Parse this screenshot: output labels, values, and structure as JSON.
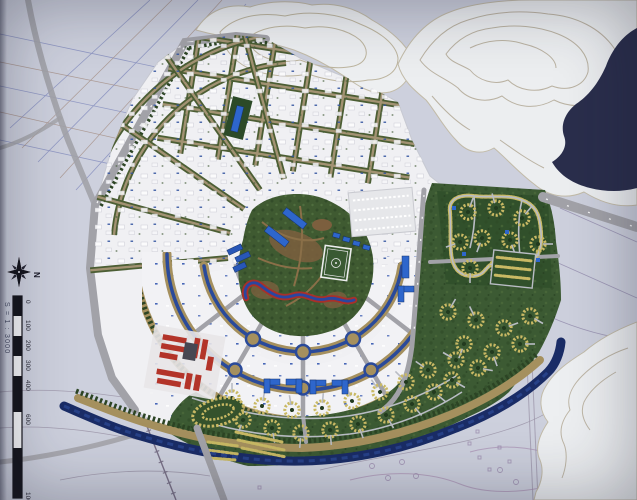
{
  "meta": {
    "description": "Photograph of a physical architectural scale model of an urban master plan mounted on a printed survey site plan",
    "visible_model_parts": "white villa districts, central park with soccer field, blue landmark buildings, red housing block, green cul-de-sac districts, river with beach, white contour terrain hills"
  },
  "compass": {
    "north_label": "N"
  },
  "scale_bar": {
    "ratio_label": "S = 1 : 3000",
    "tick_labels": [
      "0",
      "100",
      "200",
      "300",
      "400",
      "600",
      "1000"
    ]
  },
  "palette": {
    "paper": "#c9ccdb",
    "paper_line_blue": "#7d87bb",
    "paper_line_brown": "#a18a7e",
    "paper_line_pink": "#ab94b4",
    "terrain_white": "#edeff1",
    "terrain_contour": "#bab2a2",
    "dark_water_inlet": "#2a2e4c",
    "road_gray": "#a2a2a8",
    "plan_white": "#f0f0f3",
    "park_green": "#3f5a31",
    "district_green": "#3c5a33",
    "tree_green": "#2c4424",
    "path_tan": "#a5905e",
    "house_yellow": "#c9b964",
    "canal_blue": "#2a4a9a",
    "river_navy": "#1a2c66",
    "building_blue": "#2e66cc",
    "building_red": "#b33429",
    "field_marking_white": "#e8e8ea"
  }
}
